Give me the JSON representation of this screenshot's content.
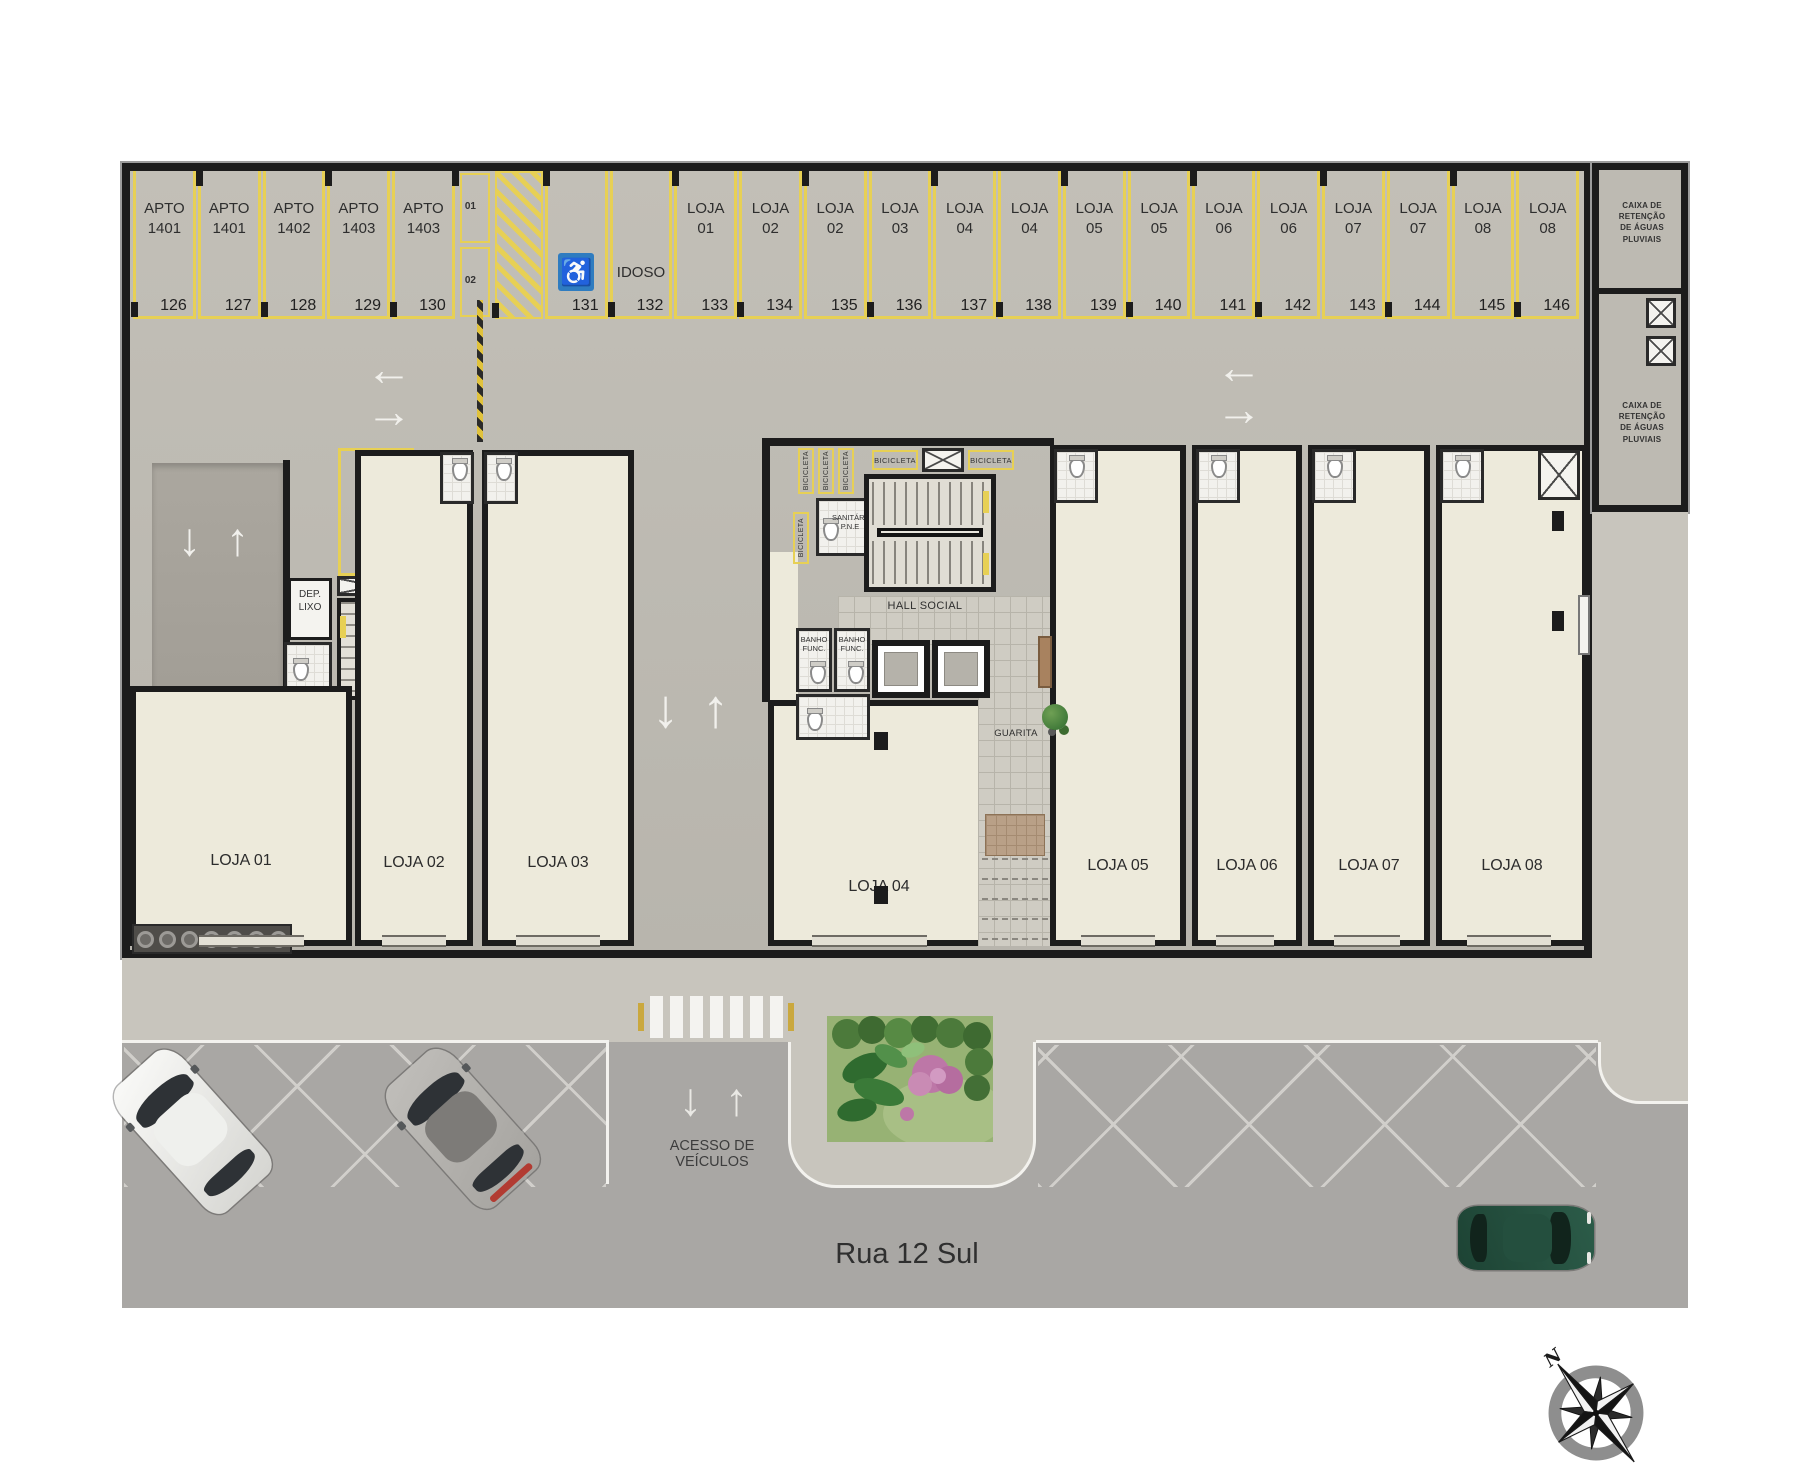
{
  "parking_row": {
    "spots": [
      {
        "label": "APTO\n1401",
        "num": "126"
      },
      {
        "label": "APTO\n1401",
        "num": "127"
      },
      {
        "label": "APTO\n1402",
        "num": "128"
      },
      {
        "label": "APTO\n1403",
        "num": "129"
      },
      {
        "label": "APTO\n1403",
        "num": "130"
      },
      {
        "type": "moto",
        "labels": [
          "01",
          "02"
        ]
      },
      {
        "type": "hatch"
      },
      {
        "type": "disabled",
        "num": "131"
      },
      {
        "type": "idoso",
        "label": "IDOSO",
        "num": "132"
      },
      {
        "label": "LOJA\n01",
        "num": "133"
      },
      {
        "label": "LOJA\n02",
        "num": "134"
      },
      {
        "label": "LOJA\n02",
        "num": "135"
      },
      {
        "label": "LOJA\n03",
        "num": "136"
      },
      {
        "label": "LOJA\n04",
        "num": "137"
      },
      {
        "label": "LOJA\n04",
        "num": "138"
      },
      {
        "label": "LOJA\n05",
        "num": "139"
      },
      {
        "label": "LOJA\n05",
        "num": "140"
      },
      {
        "label": "LOJA\n06",
        "num": "141"
      },
      {
        "label": "LOJA\n06",
        "num": "142"
      },
      {
        "label": "LOJA\n07",
        "num": "143"
      },
      {
        "label": "LOJA\n07",
        "num": "144"
      },
      {
        "label": "LOJA\n08",
        "num": "145"
      },
      {
        "label": "LOJA\n08",
        "num": "146"
      }
    ]
  },
  "rooms": {
    "caixa_top": "CAIXA DE RETENÇÃO\nDE ÁGUAS PLUVIAIS",
    "caixa_bottom": "CAIXA DE RETENÇÃO\nDE ÁGUAS PLUVIAIS",
    "apto_1404": "APTO\n1404",
    "apto_1404_num": "147",
    "dep_lixo": "DEP.\nLIXO",
    "sanitario_pne": "SANITÁRIO\nP.N.E",
    "hall_social": "HALL SOCIAL",
    "banho_func": "BANHO\nFUNC.",
    "guarita": "GUARITA",
    "bicicleta": "BICICLETA"
  },
  "stores": [
    {
      "name": "LOJA 01"
    },
    {
      "name": "LOJA 02"
    },
    {
      "name": "LOJA 03"
    },
    {
      "name": "LOJA 04"
    },
    {
      "name": "LOJA 05"
    },
    {
      "name": "LOJA 06"
    },
    {
      "name": "LOJA 07"
    },
    {
      "name": "LOJA 08"
    }
  ],
  "street": {
    "name": "Rua 12 Sul",
    "access": "ACESSO DE\nVEÍCULOS"
  },
  "icons": {
    "wheelchair": "♿",
    "arrow_up": "↑",
    "arrow_down": "↓",
    "arrow_left": "←",
    "arrow_right": "→",
    "compass_north": "N"
  },
  "colors": {
    "accent_yellow": "#e7d055",
    "disabled_blue": "#2f7cc0"
  }
}
